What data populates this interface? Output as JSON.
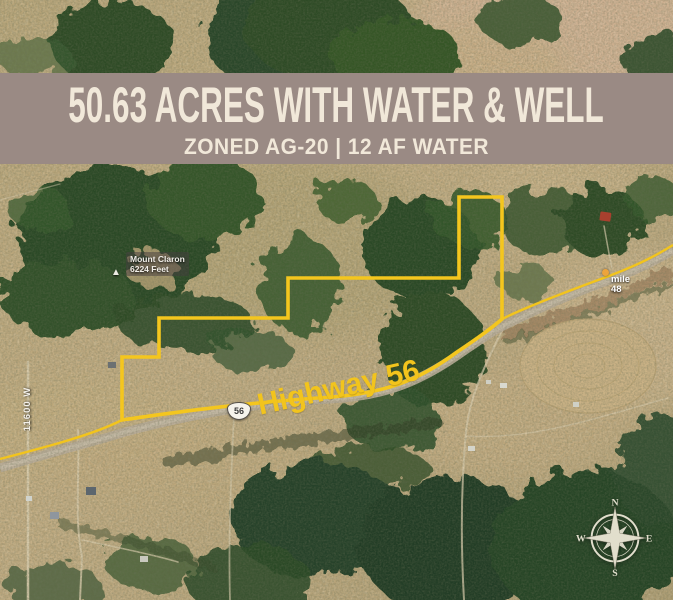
{
  "banner": {
    "title": "50.63 ACRES WITH WATER & WELL",
    "subtitle": "ZONED AG-20 | 12 AF WATER",
    "background_color": "#9a8a84",
    "text_color": "#f1e8d9"
  },
  "map": {
    "parcel_outline_color": "#f2c41d",
    "highway": {
      "label": "Highway 56",
      "shield_number": "56"
    },
    "mile_marker": {
      "word": "mile",
      "number": "48"
    },
    "mountain_label": {
      "name": "Mount Claron",
      "elevation": "6224 Feet"
    },
    "street_label": "11600 W",
    "compass": {
      "north": "N",
      "east": "E",
      "south": "S",
      "west": "W"
    }
  }
}
